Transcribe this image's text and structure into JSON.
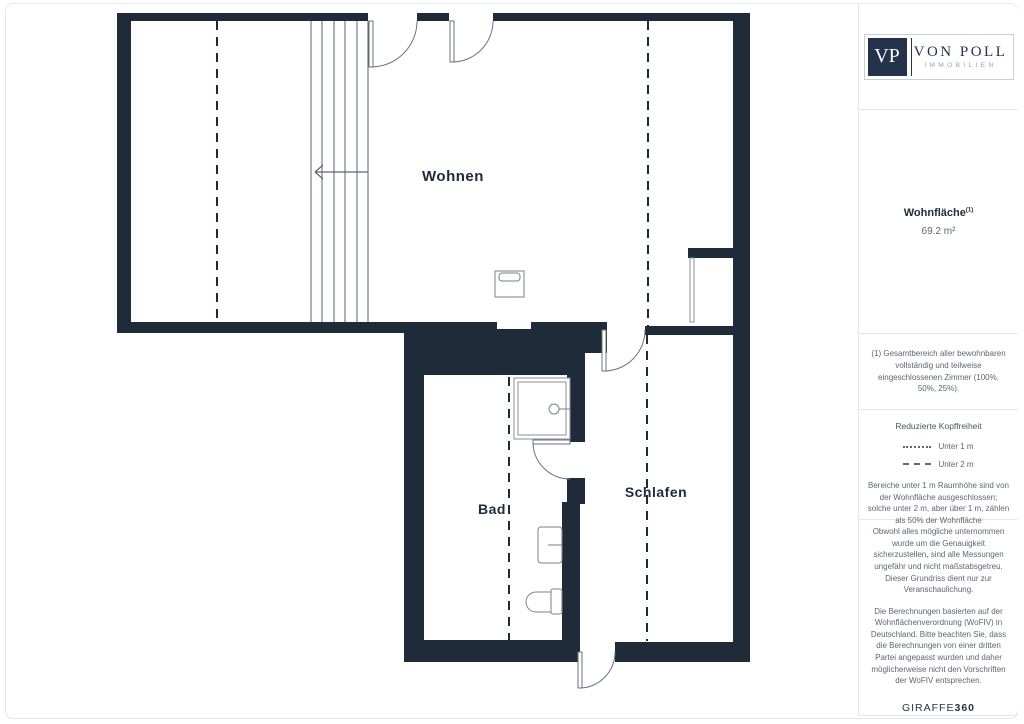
{
  "plan": {
    "rooms": [
      {
        "name": "Wohnen"
      },
      {
        "name": "Bad"
      },
      {
        "name": "Schlafen"
      }
    ]
  },
  "sidebar": {
    "logo": {
      "monogram": "VP",
      "brand": "VON POLL",
      "sub": "IMMOBILIEN"
    },
    "area": {
      "label": "Wohnfläche",
      "footnote_marker": "(1)",
      "value": "69.2 m²"
    },
    "footnote": "(1) Gesamtbereich aller bewohnbaren vollständig und teilweise eingeschlossenen Zimmer (100%, 50%, 25%).",
    "legend": {
      "title": "Reduzierte Kopffreiheit",
      "items": [
        {
          "label": "Unter 1 m",
          "style": "dotted"
        },
        {
          "label": "Unter 2 m",
          "style": "dashed"
        }
      ],
      "note": "Bereiche unter 1 m Raumhöhe sind von der Wohnfläche ausgeschlossen; solche unter 2 m, aber über 1 m, zählen als 50% der Wohnfläche"
    },
    "disclaimer1": "Obwohl alles mögliche unternommen wurde um die Genauigkeit sicherzustellen, sind alle Messungen ungefähr und nicht maßstabsgetreu. Dieser Grundriss dient nur zur Veranschaulichung.",
    "disclaimer2": "Die Berechnungen basierten auf der Wohnflächenverordnung (WoFIV) in Deutschland. Bitte beachten Sie, dass die Berechnungen von einer dritten Partei angepasst wurden und daher möglicherweise nicht den Vorschriften der WoFIV entsprechen.",
    "credit": {
      "brand": "GIRAFFE",
      "suffix": "360"
    }
  },
  "colors": {
    "wall": "#1f2b38",
    "logo_navy": "#24324b",
    "text_gray": "#5c6672",
    "border": "#e1e7ed"
  }
}
